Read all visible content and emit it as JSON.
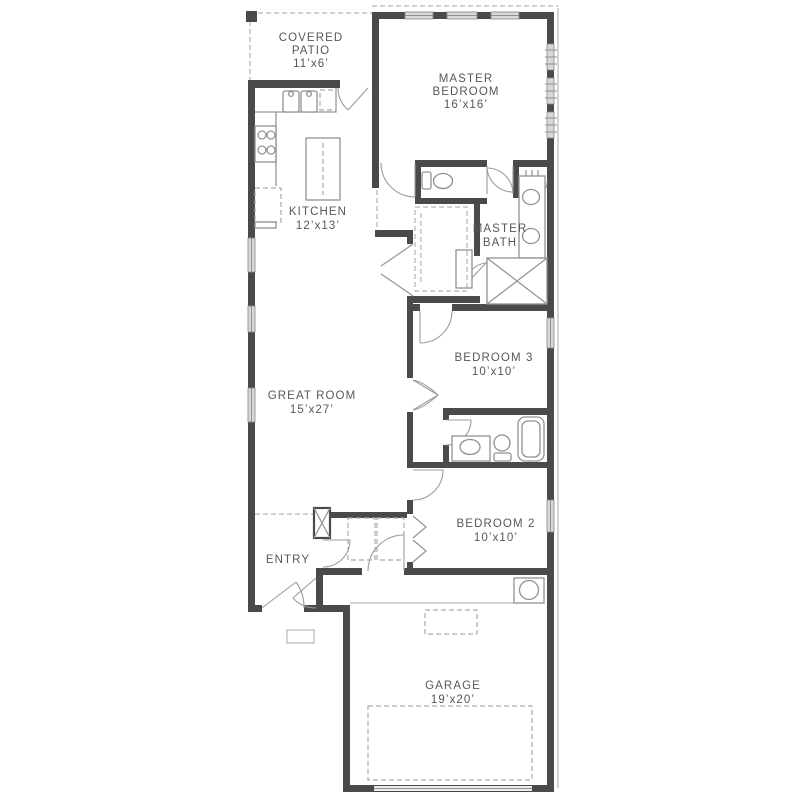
{
  "title": "single-story-house-floor-plan",
  "colors": {
    "wall": "#4a4a4c",
    "window_fill": "#d7d8d9",
    "fixture_line": "#8f9193",
    "dashed_line": "#b2b4b6",
    "label_text": "#56585a",
    "background": "#ffffff"
  },
  "rooms": {
    "covered_patio": {
      "l1": "COVERED",
      "l2": "PATIO",
      "dims": "11’x6’"
    },
    "master_bedroom": {
      "l1": "MASTER",
      "l2": "BEDROOM",
      "dims": "16’x16’"
    },
    "kitchen": {
      "l1": "KITCHEN",
      "dims": "12’x13’"
    },
    "master_bath": {
      "l1": "MASTER",
      "l2": "BATH"
    },
    "great_room": {
      "l1": "GREAT ROOM",
      "dims": "15’x27’"
    },
    "bedroom_3": {
      "l1": "BEDROOM 3",
      "dims": "10’x10’"
    },
    "bedroom_2": {
      "l1": "BEDROOM 2",
      "dims": "10’x10’"
    },
    "entry": {
      "l1": "ENTRY"
    },
    "garage": {
      "l1": "GARAGE",
      "dims": "19’x20’"
    }
  },
  "fixtures": [
    "double-kitchen-sink",
    "cooktop",
    "refrigerator-space",
    "dishwasher-space",
    "kitchen-island",
    "water-closet-toilet",
    "linen-shelves",
    "double-vanity",
    "shower",
    "shower-bench",
    "closet-shelving",
    "bathtub",
    "hall-vanity",
    "hall-toilet",
    "washer-dryer-space",
    "water-heater",
    "garage-door",
    "attic-access",
    "front-porch-stoop"
  ]
}
